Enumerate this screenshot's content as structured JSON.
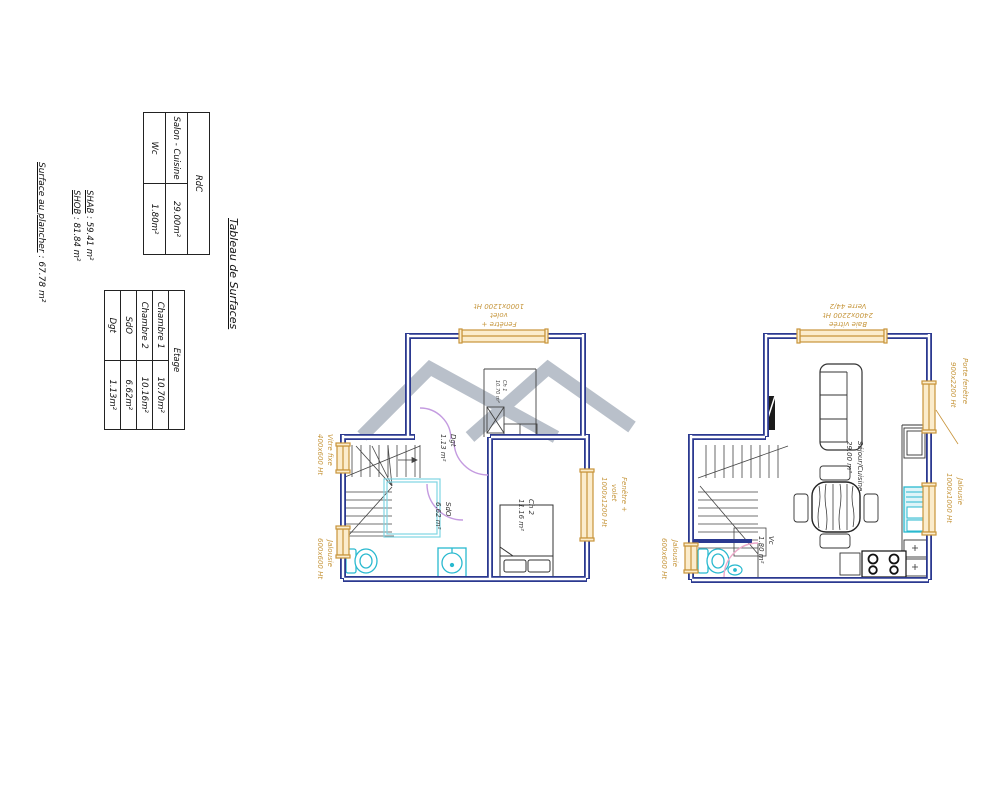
{
  "surface_block": {
    "title": "Tableau de Surfaces",
    "rdc_table": {
      "header": "RdC",
      "rows": [
        {
          "label": "Salon - Cuisine",
          "value": "29.00m²"
        },
        {
          "label": "Wc",
          "value": "1.80m²"
        }
      ]
    },
    "etage_table": {
      "header": "Etage",
      "rows": [
        {
          "label": "Chambre 1",
          "value": "10.70m²"
        },
        {
          "label": "Chambre 2",
          "value": "10.16m²"
        },
        {
          "label": "SdO",
          "value": "6.62m²"
        },
        {
          "label": "Dgt",
          "value": "1.13m²"
        }
      ]
    },
    "summary": {
      "shab_label": "SHAB",
      "shab_value": " : 59.41 m²",
      "shob_label": "SHOB",
      "shob_value": " : 81.84 m²",
      "plancher_label": "Surface au plancher",
      "plancher_value": " : 67.78 m²"
    }
  },
  "plan_etage": {
    "rooms": {
      "ch1": {
        "name": "Ch 1",
        "area": "10.70 m²"
      },
      "ch2": {
        "name": "Ch 2",
        "area": "11.16 m²"
      },
      "sdo": {
        "name": "SdO",
        "area": "6.62 m²"
      },
      "dgt": {
        "name": "Dgt",
        "area": "1.13 m²"
      }
    },
    "annotations": {
      "window_top": {
        "l1": "Fenêtre +",
        "l2": "volet",
        "l3": "1000x1200 Ht"
      },
      "window_right": {
        "l1": "Fenêtre +",
        "l2": "volet",
        "l3": "1000x1200 Ht"
      },
      "window_left_top": {
        "l1": "Vitre fixe",
        "l2": "400x600 Ht"
      },
      "window_left_bottom": {
        "l1": "Jalousie",
        "l2": "600x600 Ht"
      }
    }
  },
  "plan_rdc": {
    "rooms": {
      "sejour": {
        "name": "Séjour/Cuisine",
        "area": "29.00 m²"
      },
      "vc": {
        "name": "Vc",
        "area": "1.80 m²"
      }
    },
    "annotations": {
      "bay_top": {
        "l1": "Baie vitrée",
        "l2": "2400x2200 Ht",
        "l3": "Verre 44/2"
      },
      "door_window_right": {
        "l1": "Porte fenêtre",
        "l2": "900x2200 Ht"
      },
      "window_right": {
        "l1": "Jalousie",
        "l2": "1000x1000 Ht"
      },
      "window_left": {
        "l1": "Jalousie",
        "l2": "600x600 Ht"
      }
    }
  },
  "colors": {
    "wall_blue": "#2b3990",
    "window_tan": "#c8943a",
    "window_fill": "#fbeccc",
    "fixture_cyan": "#29b9cf",
    "door_violet": "#c49be0",
    "door_pink": "#eda9c9",
    "watermark_gray": "#b9c0ca"
  }
}
